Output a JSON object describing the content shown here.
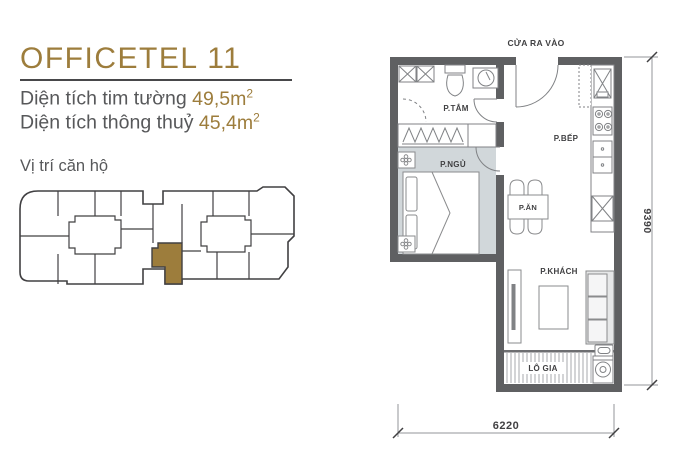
{
  "panel": {
    "title": "OFFICETEL 11",
    "area_gross": {
      "label": "Diện tích tim tường",
      "value": "49,5m",
      "sup": "2"
    },
    "area_net": {
      "label": "Diện tích thông thuỷ",
      "value": "45,4m",
      "sup": "2"
    },
    "location_label": "Vị trí căn hộ"
  },
  "floorplan": {
    "entrance_label": "CỬA RA VÀO",
    "rooms": {
      "bathroom": "P.TẮM",
      "bedroom": "P.NGỦ",
      "kitchen": "P.BẾP",
      "dining": "P.ĂN",
      "living": "P.KHÁCH",
      "loggia": "LÔ GIA"
    },
    "dimensions": {
      "width": "6220",
      "height": "9390"
    }
  },
  "icons": [
    "toilet-icon",
    "sink-icon",
    "washer-icon",
    "stove-icon",
    "kitchen-sink-icon",
    "bed-icon",
    "wardrobe-icon",
    "sofa-icon",
    "tv-icon",
    "dining-table-icon",
    "door-swing-icon",
    "ac-unit-icon"
  ],
  "colors": {
    "accent_gold": "#9d7d3c",
    "text_gray": "#57585a",
    "wall_gray": "#5f6062",
    "line_dark": "#414042",
    "bedroom_floor": "#d1d7da"
  }
}
